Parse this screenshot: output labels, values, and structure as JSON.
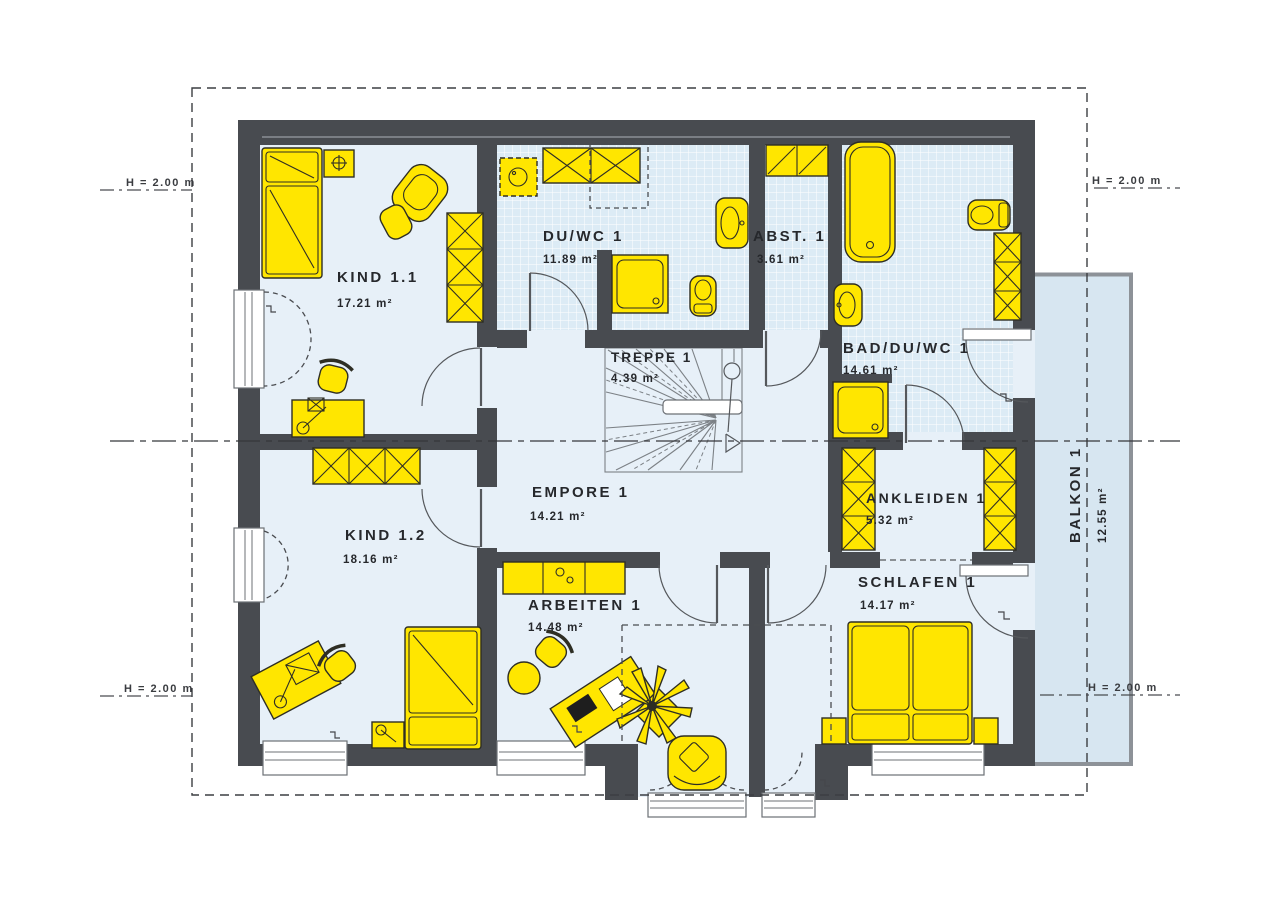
{
  "drawing_type": "floor-plan",
  "rooms": [
    {
      "id": "kind-1-1",
      "name": "KIND 1.1",
      "area": "17.21 m²"
    },
    {
      "id": "du-wc-1",
      "name": "DU/WC 1",
      "area": "11.89 m²"
    },
    {
      "id": "abst-1",
      "name": "ABST. 1",
      "area": "3.61 m²"
    },
    {
      "id": "bad-du-wc-1",
      "name": "BAD/DU/WC 1",
      "area": "14.61 m²"
    },
    {
      "id": "treppe-1",
      "name": "TREPPE 1",
      "area": "4.39 m²"
    },
    {
      "id": "empore-1",
      "name": "EMPORE 1",
      "area": "14.21 m²"
    },
    {
      "id": "kind-1-2",
      "name": "KIND 1.2",
      "area": "18.16 m²"
    },
    {
      "id": "arbeiten-1",
      "name": "ARBEITEN 1",
      "area": "14.48 m²"
    },
    {
      "id": "ankleiden-1",
      "name": "ANKLEIDEN 1",
      "area": "5.32 m²"
    },
    {
      "id": "schlafen-1",
      "name": "SCHLAFEN 1",
      "area": "14.17 m²"
    },
    {
      "id": "balkon-1",
      "name": "BALKON 1",
      "area": "12.55 m²"
    }
  ],
  "height_markers": {
    "label": "H = 2.00 m"
  },
  "colors": {
    "wall": "#484b50",
    "floor": "#e7f0f8",
    "tile": "#dcebf5",
    "furniture": "#ffe600",
    "balcony": "#d7e6f1",
    "text": "#26282c"
  }
}
